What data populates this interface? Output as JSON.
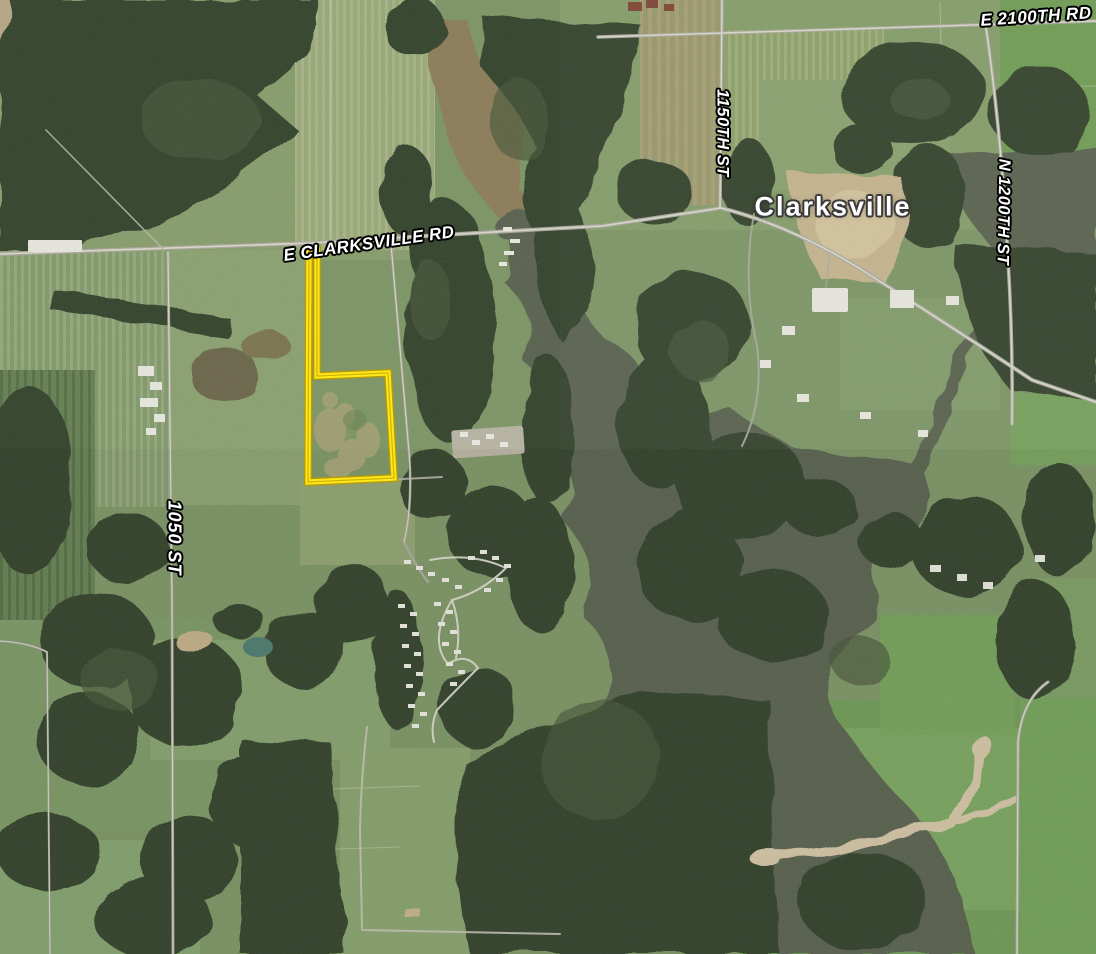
{
  "map": {
    "description": "Aerial satellite map of the Clarksville area with a highlighted flag-shaped property parcel outlined in yellow near E Clarksville Rd",
    "town_label": "Clarksville",
    "road_labels": [
      {
        "id": "e-2100th-rd",
        "text": "E 2100TH RD"
      },
      {
        "id": "1150th-st",
        "text": "1150TH ST"
      },
      {
        "id": "n-1200th-st",
        "text": "N 1200TH ST"
      },
      {
        "id": "e-clarksville-rd",
        "text": "E CLARKSVILLE RD"
      },
      {
        "id": "1050-st",
        "text": "1050 ST"
      }
    ],
    "parcel": {
      "outline_color": "#ffe81a",
      "outline_casing_color": "#bb9a00",
      "shape": "flag-shaped parcel: narrow frontage strip from E Clarksville Rd to a rectangular field"
    },
    "palette": {
      "field_green": "#7b9464",
      "forest_green": "#33422c",
      "water_dark": "#59604e",
      "water_muddy": "#8b7b58",
      "pond_teal": "#4d7a6e",
      "dirt_tan": "#c3b28c",
      "road_gray": "#a8a79a",
      "label_text": "#ffffff",
      "label_outline": "#000000"
    }
  }
}
